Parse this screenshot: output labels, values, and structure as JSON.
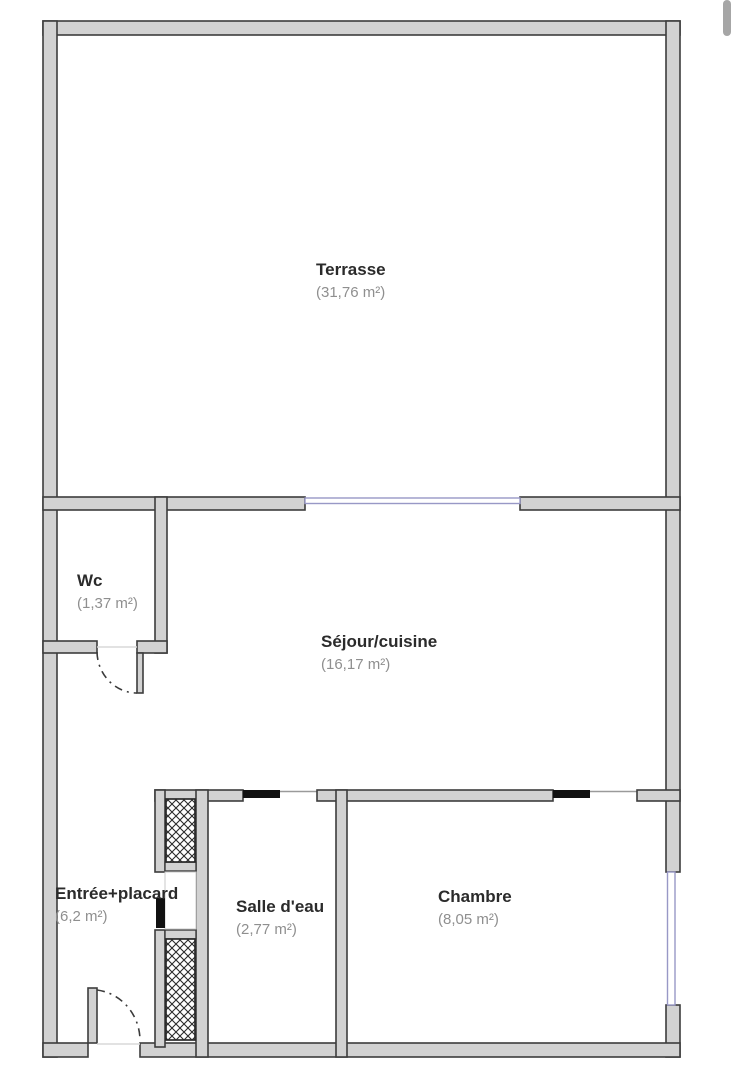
{
  "rooms": [
    {
      "name": "Terrasse",
      "area": "(31,76 m²)"
    },
    {
      "name": "Wc",
      "area": "(1,37 m²)"
    },
    {
      "name": "Séjour/cuisine",
      "area": "(16,17 m²)"
    },
    {
      "name": "Entrée+placard",
      "area": "(6,2 m²)"
    },
    {
      "name": "Salle d'eau",
      "area": "(2,77 m²)"
    },
    {
      "name": "Chambre",
      "area": "(8,05 m²)"
    }
  ],
  "colors": {
    "wall_fill": "#d2d2d2",
    "wall_outline": "#3d3d3d",
    "window_accent": "#9898c6",
    "door_panel_black": "#111111",
    "room_name_text": "#2b2b2b",
    "room_area_text": "#8f8f8f",
    "scrollbar_thumb": "#a6a6a6",
    "background": "#ffffff"
  }
}
